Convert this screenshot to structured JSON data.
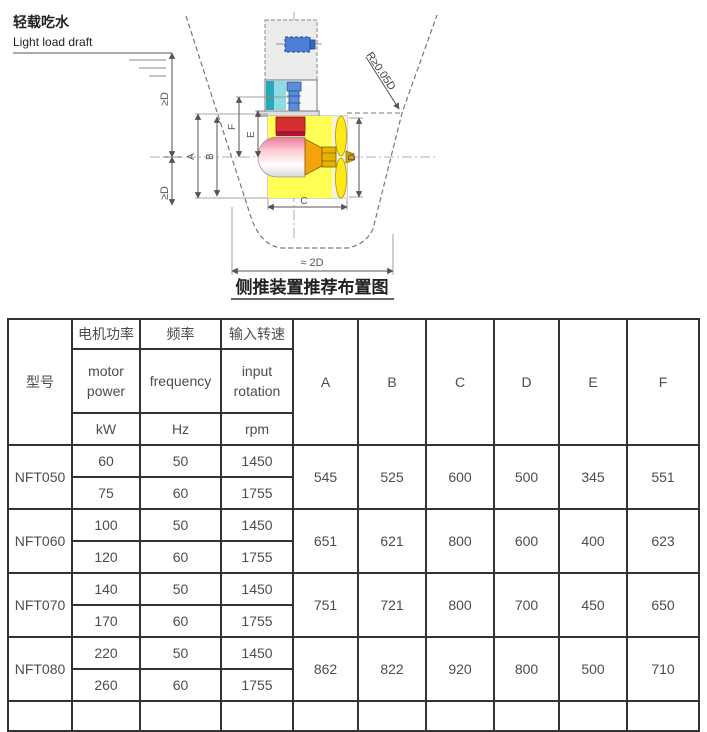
{
  "diagram": {
    "light_load_draft_zh": "轻载吃水",
    "light_load_draft_en": "Light load draft",
    "ge_d_label_upper": "≥D",
    "ge_d_label_lower": "≥D",
    "radius_label": "R≥0.05D",
    "approx_2d_label": "≈ 2D",
    "caption": "侧推装置推荐布置图",
    "dims": {
      "A": "A",
      "B": "B",
      "C": "C",
      "D": "D",
      "E": "E",
      "F": "F"
    },
    "colors": {
      "motor_blue": "#4d7fd6",
      "shaft_blue": "#5b8dd9",
      "gear_teal": "#2aa7b8",
      "gear_teal_light": "#8edce2",
      "gearbox_red": "#d43030",
      "gearbox_red_dark": "#aa1238",
      "cone_orange": "#f2a40a",
      "propeller_yellow": "#ffe818",
      "hub_gold": "#e6b400",
      "tunnel_yellow": "#ffff55",
      "tunnel_pale": "#ffffc2"
    }
  },
  "table": {
    "header": {
      "model": "型号",
      "power": {
        "zh": "电机功率",
        "en_line1": "motor",
        "en_line2": "power",
        "unit": "kW"
      },
      "frequency": {
        "zh": "频率",
        "en": "frequency",
        "unit": "Hz"
      },
      "rotation": {
        "zh": "输入转速",
        "en_line1": "input",
        "en_line2": "rotation",
        "unit": "rpm"
      },
      "dims": [
        "A",
        "B",
        "C",
        "D",
        "E",
        "F"
      ]
    },
    "models": [
      {
        "name": "NFT050",
        "variants": [
          {
            "kw": "60",
            "hz": "50",
            "rpm": "1450"
          },
          {
            "kw": "75",
            "hz": "60",
            "rpm": "1755"
          }
        ],
        "dims": {
          "A": "545",
          "B": "525",
          "C": "600",
          "D": "500",
          "E": "345",
          "F": "551"
        }
      },
      {
        "name": "NFT060",
        "variants": [
          {
            "kw": "100",
            "hz": "50",
            "rpm": "1450"
          },
          {
            "kw": "120",
            "hz": "60",
            "rpm": "1755"
          }
        ],
        "dims": {
          "A": "651",
          "B": "621",
          "C": "800",
          "D": "600",
          "E": "400",
          "F": "623"
        }
      },
      {
        "name": "NFT070",
        "variants": [
          {
            "kw": "140",
            "hz": "50",
            "rpm": "1450"
          },
          {
            "kw": "170",
            "hz": "60",
            "rpm": "1755"
          }
        ],
        "dims": {
          "A": "751",
          "B": "721",
          "C": "800",
          "D": "700",
          "E": "450",
          "F": "650"
        }
      },
      {
        "name": "NFT080",
        "variants": [
          {
            "kw": "220",
            "hz": "50",
            "rpm": "1450"
          },
          {
            "kw": "260",
            "hz": "60",
            "rpm": "1755"
          }
        ],
        "dims": {
          "A": "862",
          "B": "822",
          "C": "920",
          "D": "800",
          "E": "500",
          "F": "710"
        }
      }
    ]
  }
}
